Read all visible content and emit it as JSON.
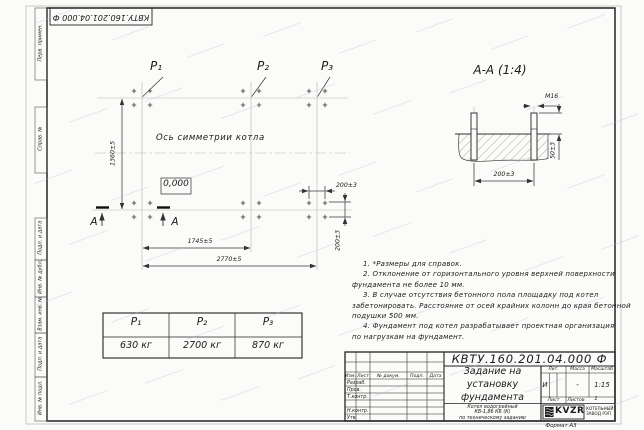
{
  "frame": {
    "stamp_top": "КВТУ.160.201.04.000 Ф",
    "format_label": "Формат А3",
    "margin_labels": [
      "Перв. примен.",
      "Справ. №",
      "Подп. и дата",
      "Инв. № дубл.",
      "Взам. инв. №",
      "Подп. и дата",
      "Инв. № подл."
    ]
  },
  "plan": {
    "load_labels": [
      "P₁",
      "P₂",
      "P₃"
    ],
    "symmetry_axis_label": "Ось симметрии котла",
    "level_mark": "0,000",
    "section_letter": "А",
    "dim_height": "1360±5",
    "dim_span_p1_p2": "1745±5",
    "dim_span_total": "2770±5",
    "dim_bolt_pitch_h": "200±3",
    "dim_bolt_pitch_v": "200±3"
  },
  "section_view": {
    "title": "А-А (1:4)",
    "bolt_thread": "М16",
    "dim_bolt_spacing": "200±3",
    "dim_bolt_protrusion": "50±3"
  },
  "loads_table": {
    "headers": [
      "P₁",
      "P₂",
      "P₃"
    ],
    "values": [
      "630 кг",
      "2700 кг",
      "870 кг"
    ]
  },
  "notes_lines": [
    "1. *Размеры для справок.",
    "2. Отклонение от горизонтального уровня верхней поверхности",
    "фундамента не более 10 мм.",
    "3. В случае отсутствия бетонного пола площадку под котел",
    "забетонировать. Расстояние от осей крайних колонн до края бетонной",
    "подушки 500 мм.",
    "4. Фундамент под котел разрабатывает проектная организация",
    "по нагрузкам на фундамент."
  ],
  "title_block": {
    "doc_number": "КВТУ.160.201.04.000 Ф",
    "revision_cols": [
      "Изм.",
      "Лист",
      "№ докум.",
      "Подп.",
      "Дата"
    ],
    "signature_rows": [
      "Разраб.",
      "Пров.",
      "Т.контр.",
      "Н.контр.",
      "Утв."
    ],
    "title_lines": [
      "Задание на",
      "установку",
      "фундамента"
    ],
    "product_lines": [
      "Котел водогрейный",
      "КВ-1,86 КБ (К)",
      "по техническому заданию"
    ],
    "lit_header": "Лит.",
    "mass_header": "Масса",
    "scale_header": "Масштаб",
    "lit_value": "И",
    "mass_value": "-",
    "scale_value": "1:15",
    "sheet_label": "Лист",
    "sheets_label": "Листов",
    "sheets_value": "1",
    "logo_text": "KVZR",
    "logo_caption_lines": [
      "КОТЕЛЬНЫЙ",
      "ЗАВОД РЭП"
    ]
  }
}
